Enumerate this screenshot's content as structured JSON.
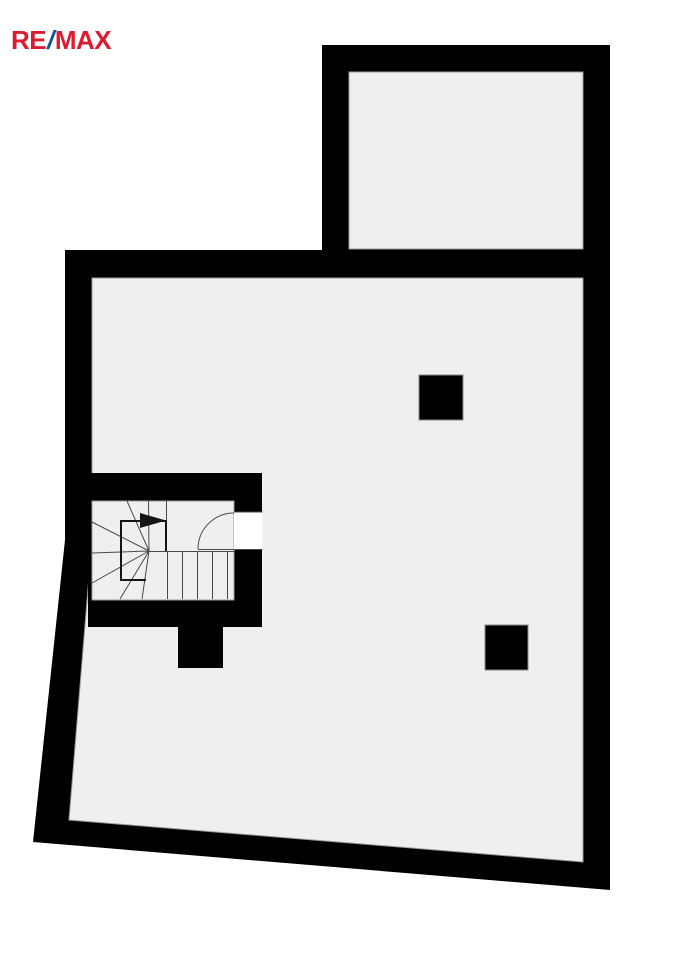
{
  "colors": {
    "background": "#ffffff",
    "wall": "#010101",
    "floor": "#efefef",
    "floor_edge": "#9b9b9b",
    "stair_line": "#4a4a4a",
    "walkline": "#141414",
    "door_white": "#ffffff",
    "logo_red": "#dc1c2e",
    "logo_blue": "#1053a0"
  },
  "logo": {
    "re": "RE",
    "slash": "/",
    "max": "MAX"
  },
  "plan": {
    "kind": "floor-plan",
    "features": [
      "upper-room",
      "main-room",
      "winder-staircase",
      "stair-direction-arrow",
      "door-swing",
      "masonry-pillar-upper",
      "masonry-pillar-lower",
      "wall-stub"
    ]
  }
}
